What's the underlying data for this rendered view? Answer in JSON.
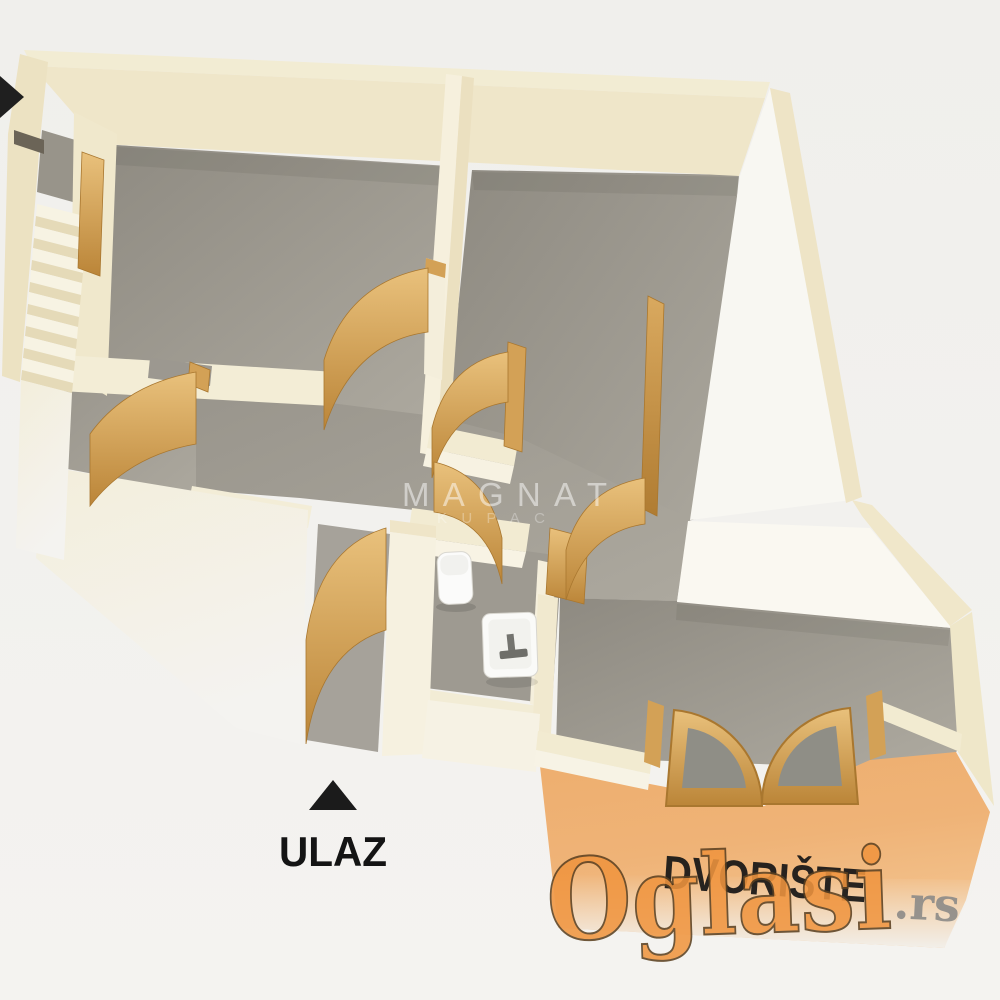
{
  "image": {
    "kind": "3d-floor-plan-render",
    "width": 1000,
    "height": 1000
  },
  "labels": {
    "entrance": "ULAZ",
    "courtyard": "DVORIŠTE"
  },
  "watermarks": {
    "center_line1": "MAGNAT",
    "center_line2": "KUPAC",
    "portal_name": "Oglasi",
    "portal_tld": ".rs"
  },
  "icons": {
    "entrance_arrow": "up-triangle-arrow",
    "side_arrow": "right-arrow"
  },
  "fixtures": {
    "stairs": "staircase",
    "toilet": "toilet",
    "sink": "washbasin",
    "doors": "wooden swing doors",
    "french_doors": "double glazed courtyard doors"
  },
  "palette": {
    "background": "#f2f1ee",
    "wall_cream_top": "#f2ecd3",
    "wall_cream_mid": "#efe6c9",
    "wall_light_face": "#f8f5ea",
    "floor_gray_dark": "#8e8a81",
    "floor_gray_light": "#aeaaa0",
    "wood_light": "#e9c17c",
    "wood_dark": "#bb8538",
    "wood_edge": "#a9772f",
    "courtyard_orange_light": "#f2bb80",
    "courtyard_orange_dark": "#e89c52",
    "logo_orange": "#f0953f",
    "logo_outline": "#5b4020",
    "tld_gray": "#8d8b88",
    "text_black": "#161616"
  }
}
